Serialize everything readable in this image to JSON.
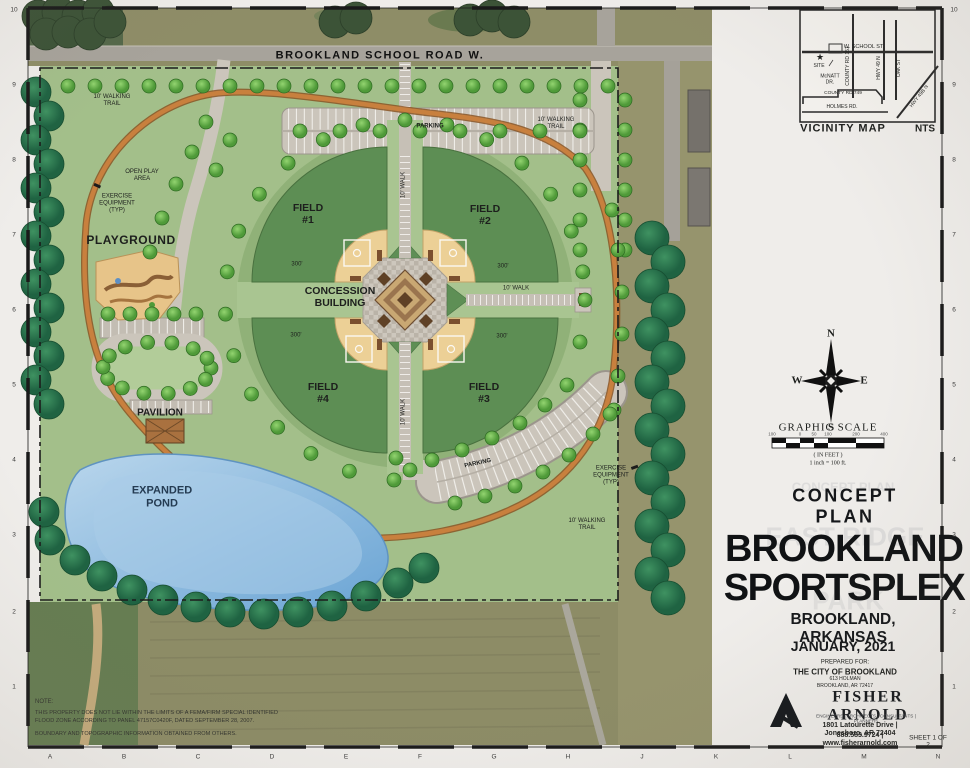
{
  "border": {
    "letters": [
      "A",
      "B",
      "C",
      "D",
      "E",
      "F",
      "G",
      "H",
      "J",
      "K",
      "L",
      "M",
      "N"
    ],
    "numbers": [
      "10",
      "9",
      "8",
      "7",
      "6",
      "5",
      "4",
      "3",
      "2",
      "1"
    ],
    "sheet_no": "SHEET 1 OF 2"
  },
  "plan": {
    "road": "BROOKLAND SCHOOL ROAD W.",
    "trail_tl": "10' WALKING\nTRAIL",
    "trail_tr": "10' WALKING\nTRAIL",
    "trail_br": "10' WALKING\nTRAIL",
    "open_play": "OPEN PLAY\nAREA",
    "exercise_l": "EXERCISE\nEQUIPMENT\n(TYP)",
    "exercise_r": "EXERCISE\nEQUIPMENT\n(TYP)",
    "playground": "PLAYGROUND",
    "pavilion": "PAVILION",
    "pond": "EXPANDED\nPOND",
    "parking_top": "PARKING",
    "parking_br": "PARKING",
    "field1": "FIELD\n#1",
    "field2": "FIELD\n#2",
    "field3": "FIELD\n#3",
    "field4": "FIELD\n#4",
    "concession": "CONCESSION\nBUILDING",
    "walk": "10' WALK",
    "dim": "300'"
  },
  "vicinity": {
    "title": "VICINITY MAP",
    "nts": "NTS",
    "school": "W. SCHOOL ST.",
    "site": "SITE",
    "star": "★",
    "mcnatt": "McNATT\nDR.",
    "county151": "COUNTY RD 151",
    "hwy49": "HWY 49 N",
    "oak": "OAK ST",
    "county749": "COUNTY RD 749",
    "holmes": "HOLMES RD.",
    "hwy49b": "HWY 49B N"
  },
  "compass": {
    "n": "N",
    "s": "S",
    "e": "E",
    "w": "W"
  },
  "scale": {
    "title": "GRAPHIC SCALE",
    "ticks": [
      "100",
      "0",
      "50",
      "100",
      "200",
      "400"
    ],
    "in_feet": "( IN FEET )",
    "ratio": "1 inch = 100 ft."
  },
  "title_block": {
    "ghost_small": "CONCEPT PLAN",
    "ghost_big1": "EAST RIDGE",
    "ghost_big2": "PARK",
    "concept": "CONCEPT PLAN",
    "name1": "BROOKLAND",
    "name2": "SPORTSPLEX",
    "city": "BROOKLAND, ARKANSAS",
    "date": "JANUARY, 2021",
    "prepared": "PREPARED FOR:",
    "client": "THE CITY OF BROOKLAND",
    "addr1": "613 HOLMAN",
    "addr2": "BROOKLAND, AR 72417",
    "firm": "FISHER ARNOLD",
    "tagline": "ENGINEERS  |  ARCHITECTS  |  CONSULTANTS  |  PLANNERS",
    "firm_addr": "1801 Latourette Drive  |  Jonesboro, AR 72404",
    "firm_phone": "888.583.9724  |  www.fisherarnold.com"
  },
  "notes": {
    "heading": "NOTE:",
    "body1": "THIS PROPERTY DOES NOT LIE WITHIN THE LIMITS OF A FEMA/FIRM SPECIAL IDENTIFIED\nFLOOD ZONE ACCORDING TO PANEL 47157C0420F, DATED SEPTEMBER 28, 2007.",
    "body2": "BOUNDARY AND TOPOGRAPHIC INFORMATION OBTAINED FROM OTHERS."
  },
  "colors": {
    "site_green": "#a3bf8a",
    "field_green": "#5d8e54",
    "tree_dark": "#2e7a4e",
    "trail_orange": "#c8803e",
    "path_gray": "#cbc5bb",
    "infield_tan": "#ecd096",
    "pond_blue": "#7fb2dc"
  }
}
